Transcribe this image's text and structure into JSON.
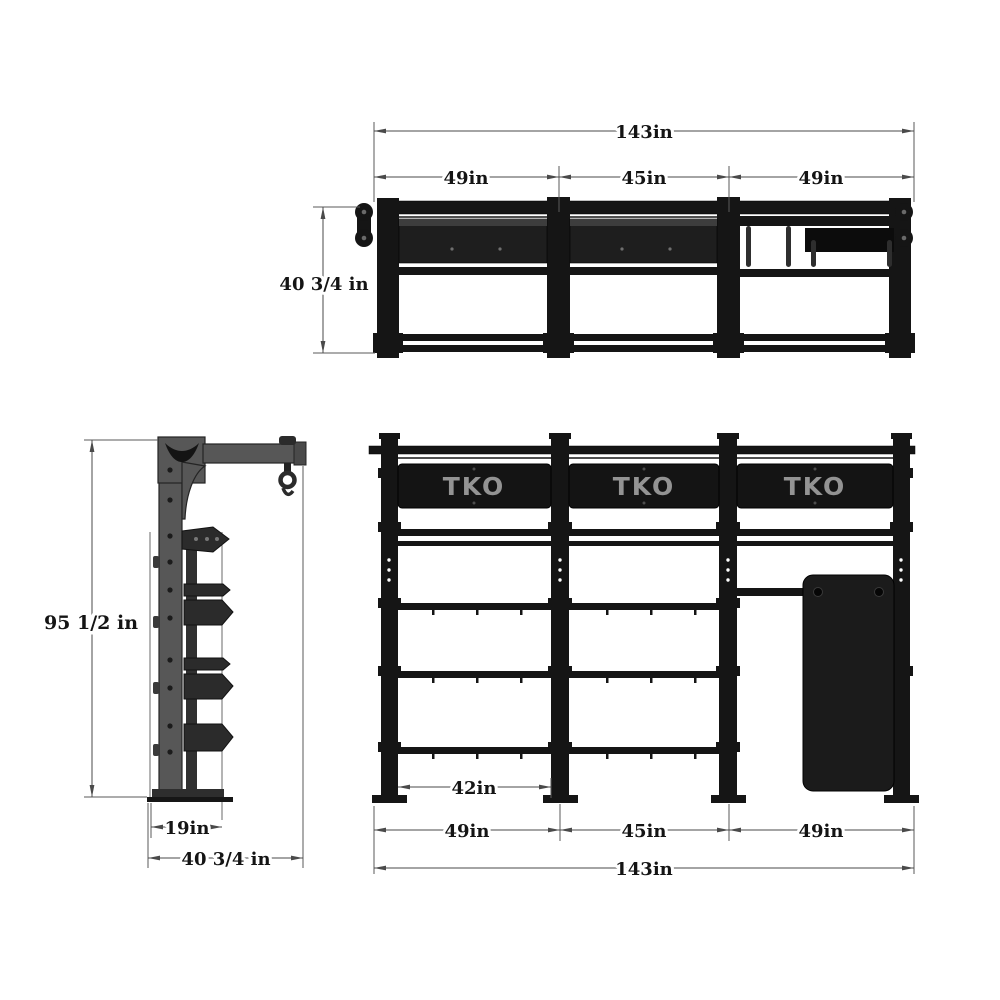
{
  "colors": {
    "background": "#ffffff",
    "structure_black": "#151515",
    "panel_black": "#1b1b1b",
    "side_view_gray": "#575757",
    "bracket_gray": "#2b2b2b",
    "dimension_line": "#4a4a4a",
    "text": "#141414",
    "logo_gray": "#939393"
  },
  "top_view": {
    "dim_total": "143in",
    "dim_seg_1": "49in",
    "dim_seg_2": "45in",
    "dim_seg_3": "49in",
    "dim_depth": "40 3/4 in"
  },
  "side_view": {
    "dim_height": "95 1/2 in",
    "dim_depth_inner": "19in",
    "dim_depth_total": "40 3/4 in"
  },
  "front_view": {
    "logo_1": "TKO",
    "logo_2": "TKO",
    "logo_3": "TKO",
    "dim_inner": "42in",
    "dim_seg_1": "49in",
    "dim_seg_2": "45in",
    "dim_seg_3": "49in",
    "dim_total": "143in"
  }
}
